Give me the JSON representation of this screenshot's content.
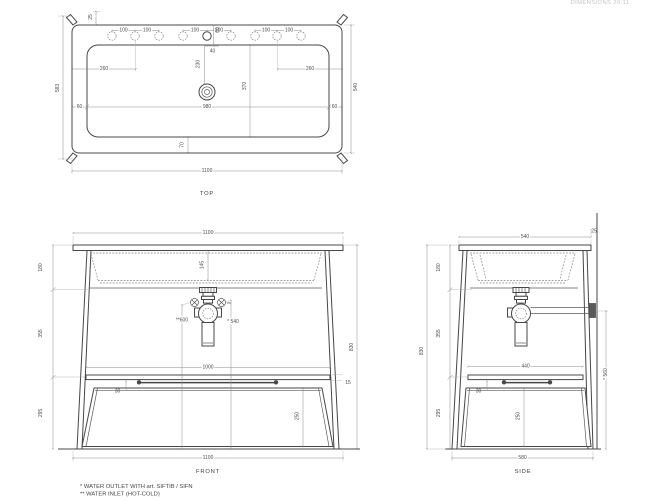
{
  "header_note": "DIMENSIONS 20.11",
  "top_view": {
    "label": "TOP",
    "overall_width": "1100",
    "depth_left": "583",
    "depth_right": "540",
    "corner_tab": "25",
    "hole_pitch": "100",
    "faucet_offset": "60",
    "faucet_to_basin": "40",
    "faucet_to_drain": "230",
    "basin_depth": "370",
    "holes_group_left": "260",
    "holes_group_right": "260",
    "rim_left": "60",
    "basin_width": "980",
    "rim_right": "60",
    "basin_front": "70"
  },
  "front_view": {
    "label": "FRONT",
    "top_width": "1100",
    "bottom_width": "1100",
    "basin_depth": "145",
    "water_inlet_height": "**600",
    "water_outlet_height": "* 540",
    "inlet_mark": "**",
    "shelf_width": "1000",
    "shelf_gap": "30",
    "top_thickness": "15",
    "panel_height": "250",
    "seg_top": "180",
    "seg_middle": "355",
    "seg_bottom": "295",
    "total_height": "830"
  },
  "side_view": {
    "label": "SIDE",
    "top_depth": "540",
    "wall_gap": "25",
    "shelf_depth": "440",
    "shelf_gap": "30",
    "panel_height": "250",
    "bottom_depth": "580",
    "seg_top": "180",
    "seg_middle": "355",
    "seg_bottom": "295",
    "total_height": "830",
    "wall_outlet_height": "* 560"
  },
  "footnotes": {
    "outlet": "*  WATER OUTLET WITH art. SIFTIB / SIFN",
    "inlet": "** WATER INLET (HOT-COLD)"
  }
}
